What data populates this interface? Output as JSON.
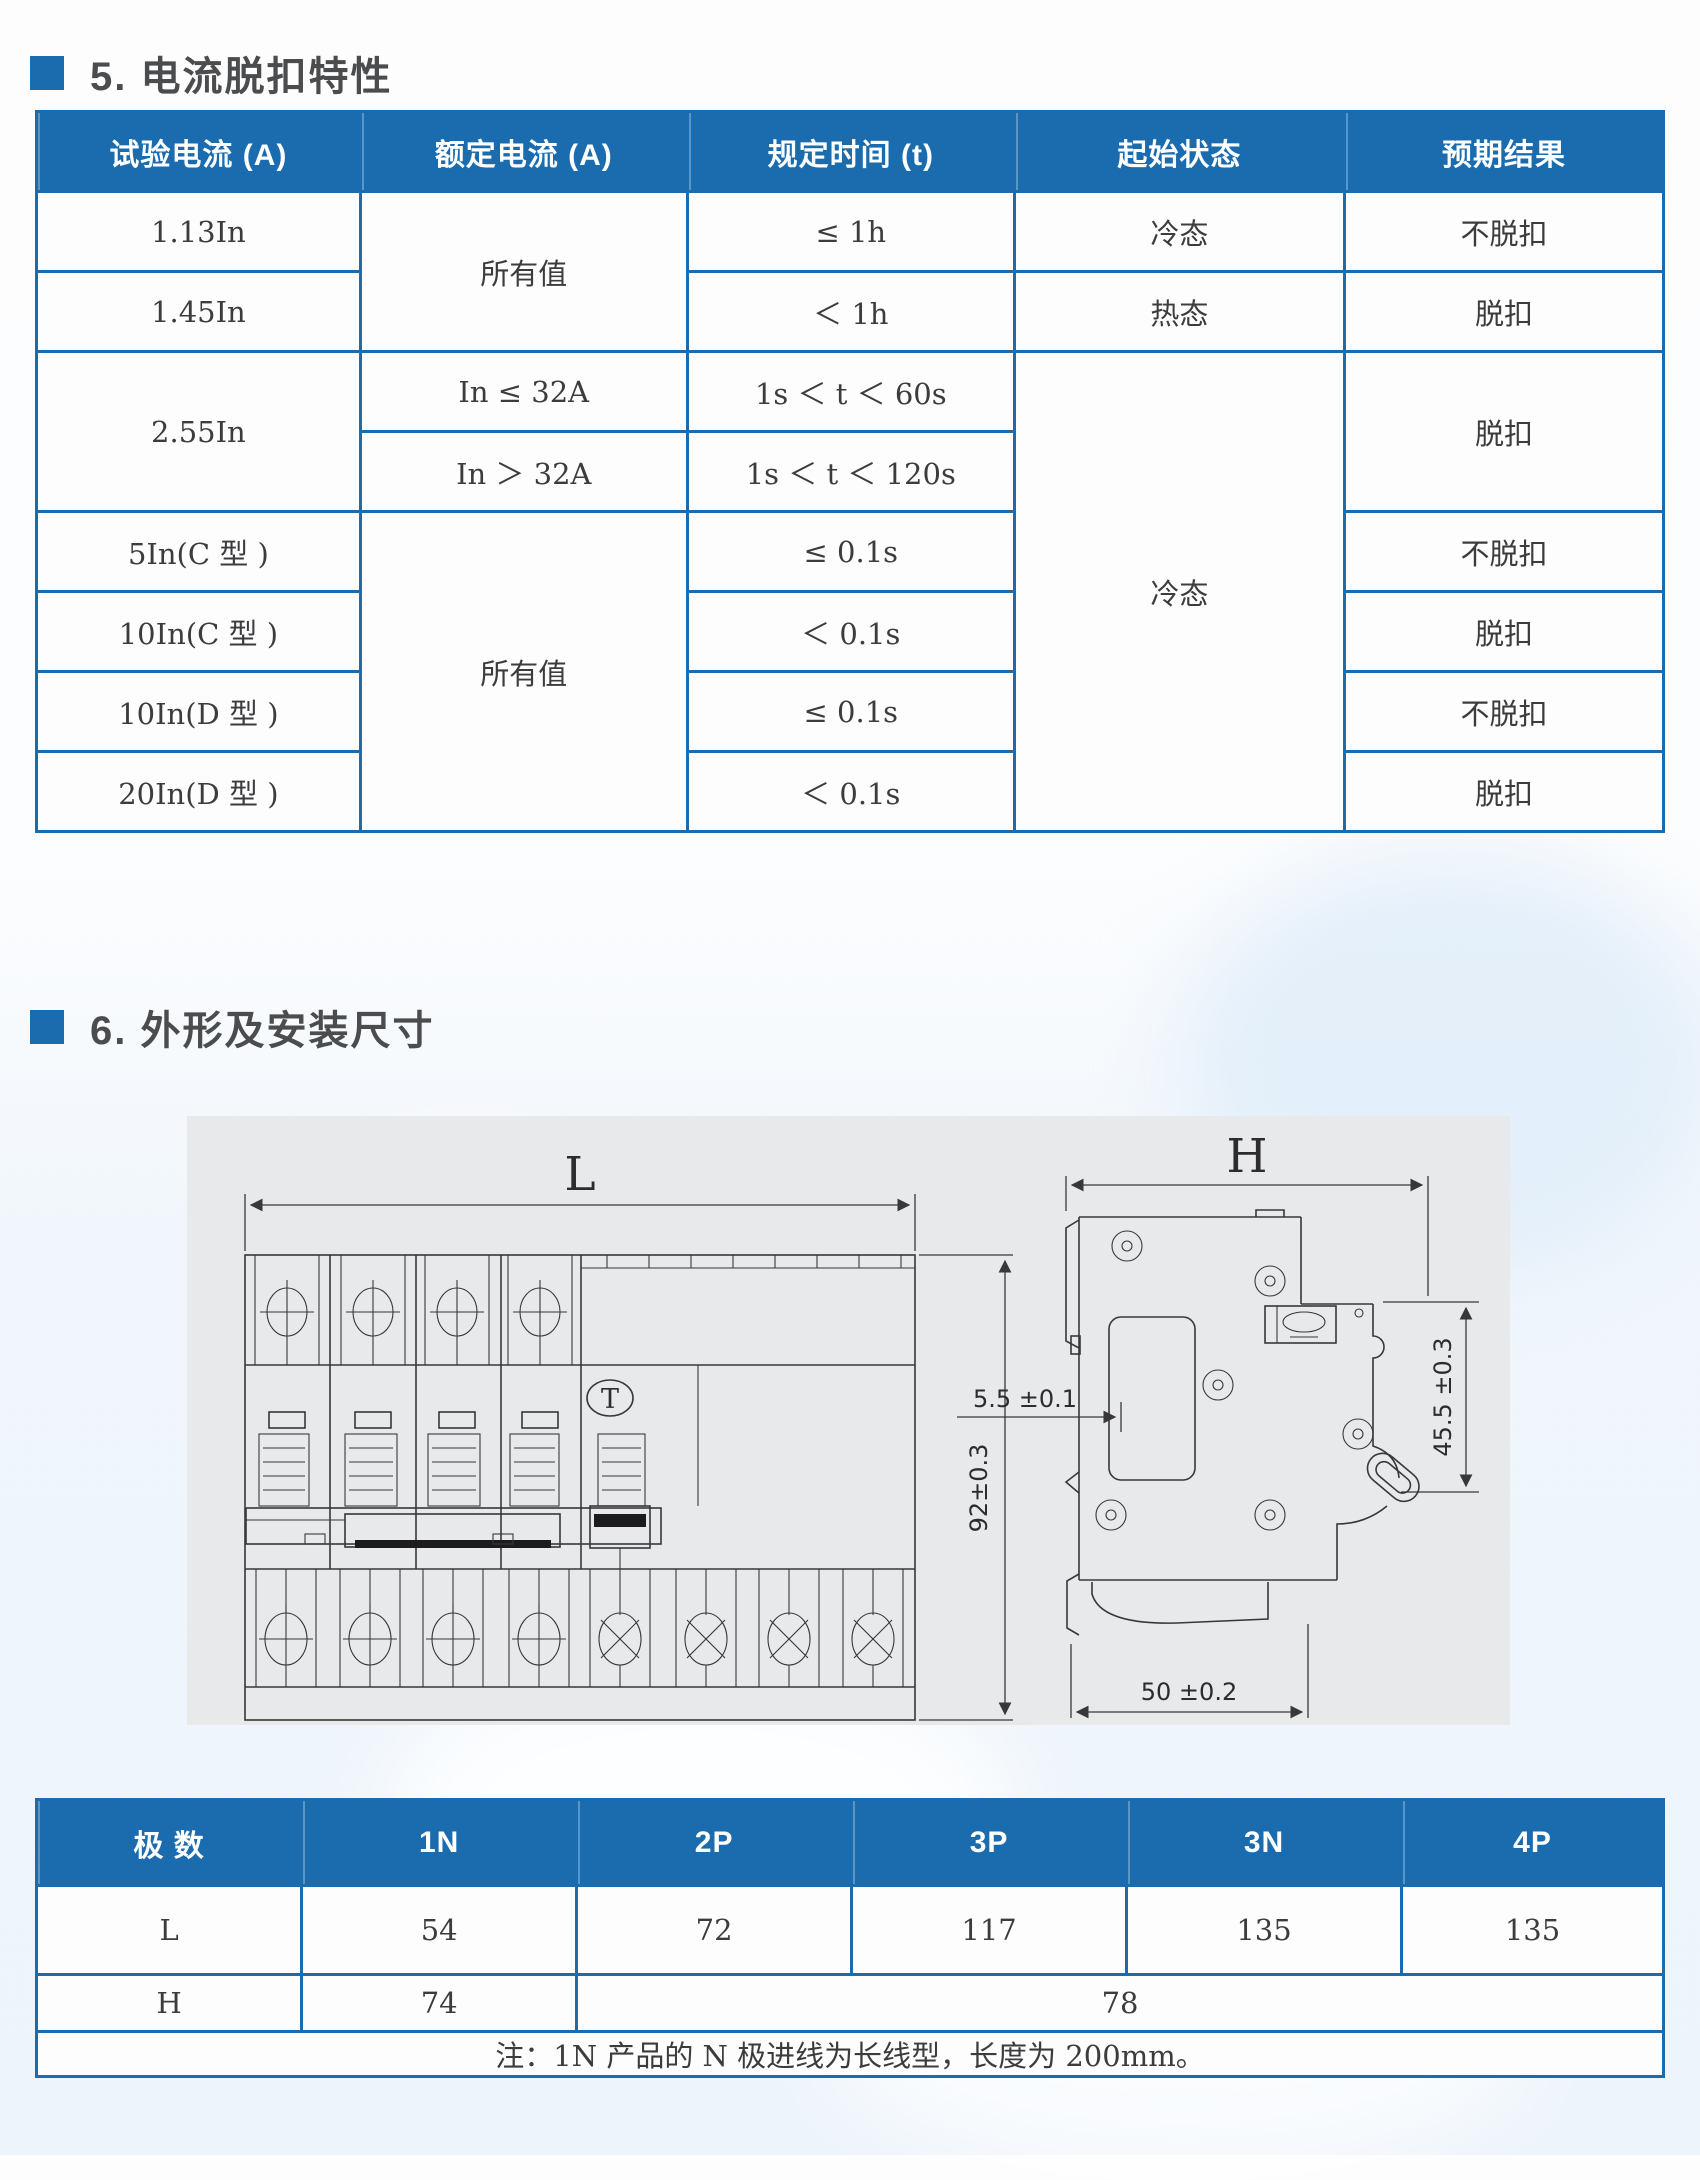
{
  "colors": {
    "accent": "#1b6cae",
    "heading_text": "#4b4c4e",
    "cell_text": "#3c3c3e",
    "panel_background": "#e8e9eb",
    "drawing_line": "#38383a"
  },
  "document": {
    "section5": {
      "title": "5. 电流脱扣特性"
    },
    "section6": {
      "title": "6. 外形及安装尺寸"
    }
  },
  "trip_table": {
    "columns": [
      "试验电流 (A)",
      "额定电流 (A)",
      "规定时间 (t)",
      "起始状态",
      "预期结果"
    ],
    "rows": [
      [
        {
          "t": "1.13In"
        },
        {
          "t": "所有值",
          "rs": 2
        },
        {
          "t": "≤ 1h"
        },
        {
          "t": "冷态"
        },
        {
          "t": "不脱扣"
        }
      ],
      [
        {
          "t": "1.45In"
        },
        {
          "t": "＜ 1h"
        },
        {
          "t": "热态"
        },
        {
          "t": "脱扣"
        }
      ],
      [
        {
          "t": "2.55In",
          "rs": 2
        },
        {
          "t": "In ≤ 32A"
        },
        {
          "t": "1s ＜ t ＜ 60s"
        },
        {
          "t": "冷态",
          "rs": 6
        },
        {
          "t": "脱扣",
          "rs": 2
        }
      ],
      [
        {
          "t": "In ＞ 32A"
        },
        {
          "t": "1s ＜ t ＜ 120s"
        }
      ],
      [
        {
          "t": "5In(C 型 )"
        },
        {
          "t": "所有值",
          "rs": 4
        },
        {
          "t": "≤ 0.1s"
        },
        {
          "t": "不脱扣"
        }
      ],
      [
        {
          "t": "10In(C 型 )"
        },
        {
          "t": "＜ 0.1s"
        },
        {
          "t": "脱扣"
        }
      ],
      [
        {
          "t": "10In(D 型 )"
        },
        {
          "t": "≤ 0.1s"
        },
        {
          "t": "不脱扣"
        }
      ],
      [
        {
          "t": "20In(D 型 )"
        },
        {
          "t": "＜ 0.1s"
        },
        {
          "t": "脱扣"
        }
      ]
    ]
  },
  "dim_table": {
    "columns": [
      "极 数",
      "1N",
      "2P",
      "3P",
      "3N",
      "4P"
    ],
    "rows": [
      [
        {
          "t": "L"
        },
        {
          "t": "54"
        },
        {
          "t": "72"
        },
        {
          "t": "117"
        },
        {
          "t": "135"
        },
        {
          "t": "135"
        }
      ],
      [
        {
          "t": "H"
        },
        {
          "t": "74"
        },
        {
          "t": "78",
          "cs": 4
        }
      ],
      [
        {
          "t": "注：1N 产品的 N 极进线为长线型，长度为 200mm。",
          "cs": 6
        }
      ]
    ]
  },
  "drawing": {
    "labels": {
      "L": "L",
      "H": "H",
      "w92": "92±0.3",
      "d55": "5.5 ±0.1",
      "d455": "45.5 ±0.3",
      "d50": "50 ±0.2",
      "test_button": "T"
    }
  }
}
